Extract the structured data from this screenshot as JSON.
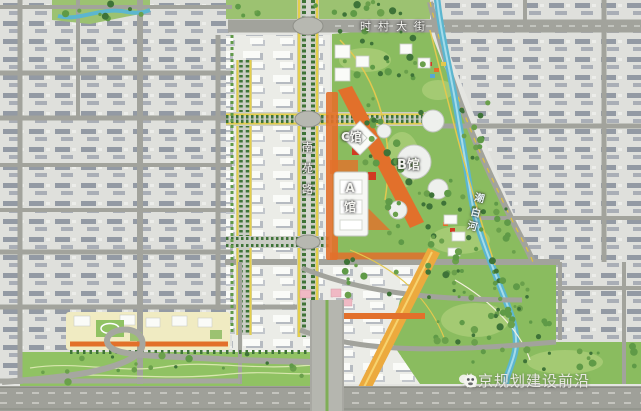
{
  "labels": {
    "street_top": "时村大街",
    "road_vertical": "南苑路",
    "venue_c": "C馆",
    "venue_b": "B馆",
    "venue_a": "A馆",
    "river_name": "潮白河"
  },
  "watermark": {
    "text": "北京规划建设前沿",
    "logo": "panda-face-icon"
  },
  "colors": {
    "base_gray": "#e4e5e1",
    "block_gray": "#dfe0dc",
    "slab_gray": "#939aa4",
    "slab_gray2": "#a9aeb6",
    "road_gray": "#a2a39c",
    "road_dark": "#8f908a",
    "plan_base": "#ebece7",
    "park_green": "#8abc5f",
    "park_light": "#a9cd77",
    "lawn_green": "#90c263",
    "tree_dark": "#3e7338",
    "tree_mid": "#5f9a47",
    "river_blue": "#5cb6cf",
    "river_light": "#a5dcea",
    "boulevard_yellow": "#e5cf4a",
    "orange": "#e2702b",
    "orange_light": "#ecaa3e",
    "red": "#d13a22",
    "cream": "#f0ebc2",
    "pink": "#f0b9c4",
    "building_white": "#fafbf8",
    "highway_gray": "#9fa099",
    "label_white": "#f5f5f1",
    "watermark_gray": "#e9e9e4"
  }
}
